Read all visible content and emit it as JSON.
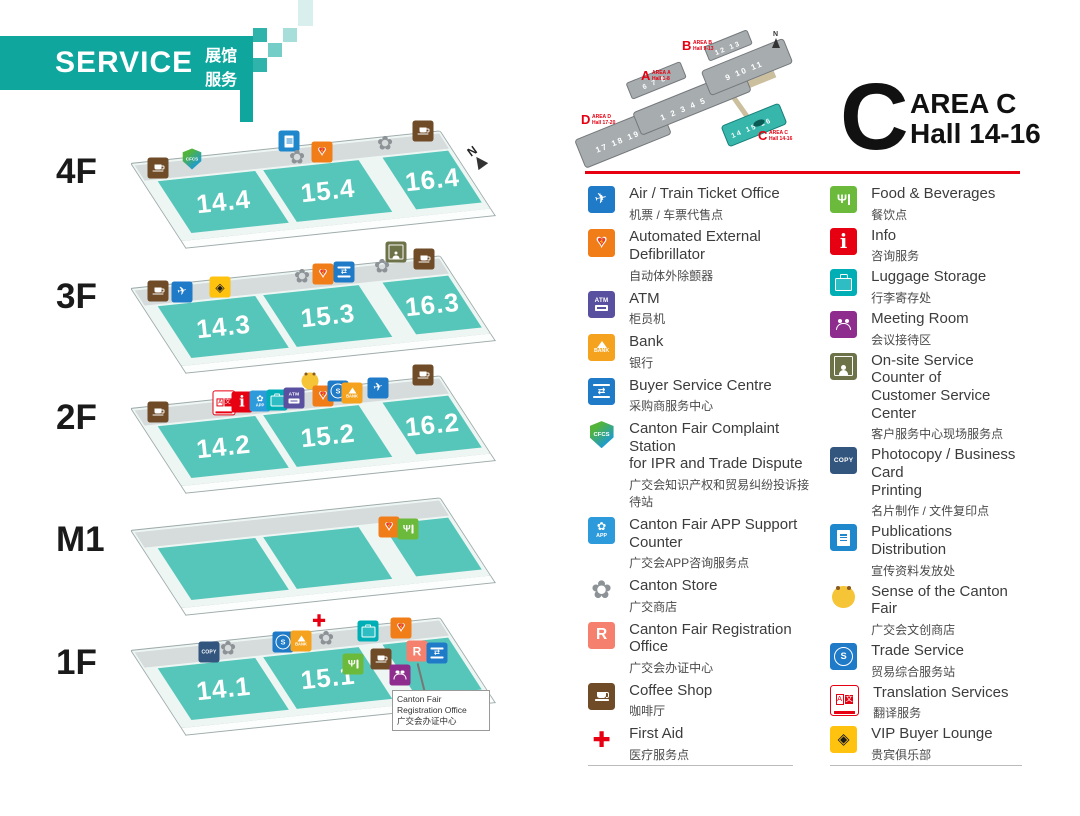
{
  "banner": {
    "title": "SERVICE",
    "subtitle_zh": "展馆服务"
  },
  "area_title": {
    "letter": "C",
    "area": "AREA C",
    "hall": "Hall 14-16"
  },
  "compass": {
    "label": "N"
  },
  "minimap": {
    "north": "N",
    "bars": {
      "a_main": "1 2 3 4 5",
      "a_up": "6 7 8",
      "b_main": "9 10 11",
      "b_up": "12 13",
      "c": "14 15 16",
      "d": "17 18 19 20"
    },
    "labels": {
      "a": {
        "letter": "A",
        "area": "AREA A",
        "hall": "Hall 1-8"
      },
      "b": {
        "letter": "B",
        "area": "AREA B",
        "hall": "Hall 9-13"
      },
      "c": {
        "letter": "C",
        "area": "AREA C",
        "hall": "Hall 14-16"
      },
      "d": {
        "letter": "D",
        "area": "AREA D",
        "hall": "Hall 17-20"
      }
    }
  },
  "floors": [
    {
      "label": "4F",
      "y": 163,
      "label_y": 152,
      "halls": [
        "14.4",
        "15.4",
        "16.4"
      ],
      "icons": [
        [
          "coffee",
          158,
          168
        ],
        [
          "cfcs",
          192,
          159
        ],
        [
          "pub",
          289,
          141
        ],
        [
          "store",
          297,
          158
        ],
        [
          "aed",
          322,
          152
        ],
        [
          "store",
          385,
          144
        ],
        [
          "coffee",
          423,
          131
        ]
      ]
    },
    {
      "label": "3F",
      "y": 288,
      "label_y": 277,
      "halls": [
        "14.3",
        "15.3",
        "16.3"
      ],
      "icons": [
        [
          "coffee",
          158,
          291
        ],
        [
          "air",
          182,
          292
        ],
        [
          "vip",
          220,
          287
        ],
        [
          "store",
          302,
          277
        ],
        [
          "aed",
          323,
          274
        ],
        [
          "buyer",
          344,
          272
        ],
        [
          "store",
          382,
          267
        ],
        [
          "onsite",
          396,
          252
        ],
        [
          "coffee",
          424,
          259
        ]
      ]
    },
    {
      "label": "2F",
      "y": 408,
      "label_y": 398,
      "halls": [
        "14.2",
        "15.2",
        "16.2"
      ],
      "icons": [
        [
          "coffee",
          158,
          412
        ],
        [
          "translate",
          224,
          403
        ],
        [
          "info",
          242,
          402
        ],
        [
          "app",
          260,
          401
        ],
        [
          "luggage",
          277,
          400
        ],
        [
          "atm",
          294,
          398
        ],
        [
          "sense",
          310,
          381
        ],
        [
          "aed",
          323,
          396
        ],
        [
          "trade",
          338,
          391
        ],
        [
          "bank",
          352,
          393
        ],
        [
          "air",
          378,
          388
        ],
        [
          "coffee",
          423,
          375
        ]
      ]
    },
    {
      "label": "M1",
      "y": 530,
      "label_y": 520,
      "halls": [
        "",
        "",
        ""
      ],
      "icons": [
        [
          "aed",
          389,
          527
        ],
        [
          "food",
          408,
          529
        ]
      ]
    },
    {
      "label": "1F",
      "y": 650,
      "label_y": 643,
      "halls": [
        "14.1",
        "15.1",
        ""
      ],
      "icons": [
        [
          "copy",
          209,
          652
        ],
        [
          "store",
          228,
          649
        ],
        [
          "trade",
          283,
          642
        ],
        [
          "bank",
          301,
          641
        ],
        [
          "firstaid",
          319,
          622
        ],
        [
          "store",
          326,
          639
        ],
        [
          "food",
          353,
          664
        ],
        [
          "luggage",
          368,
          631
        ],
        [
          "coffee",
          381,
          659
        ],
        [
          "aed",
          401,
          628
        ],
        [
          "reg",
          417,
          651
        ],
        [
          "buyer",
          437,
          653
        ],
        [
          "meeting",
          400,
          675
        ]
      ]
    }
  ],
  "callout": {
    "lines": [
      "Canton Fair",
      "Registration Office",
      "广交会办证中心"
    ]
  },
  "legend": {
    "columns": [
      [
        {
          "type": "air",
          "title": "Air / Train Ticket Office",
          "zh": "机票 / 车票代售点"
        },
        {
          "type": "aed",
          "title": "Automated External Defibrillator",
          "zh": "自动体外除颤器"
        },
        {
          "type": "atm",
          "title": "ATM",
          "zh": "柜员机"
        },
        {
          "type": "bank",
          "title": "Bank",
          "zh": "银行"
        },
        {
          "type": "buyer",
          "title": "Buyer Service Centre",
          "zh": "采购商服务中心"
        },
        {
          "type": "cfcs",
          "title": "Canton Fair Complaint Station\nfor IPR and Trade Dispute",
          "zh": "广交会知识产权和贸易纠纷投诉接待站"
        },
        {
          "type": "app",
          "title": "Canton Fair APP Support Counter",
          "zh": "广交会APP咨询服务点"
        },
        {
          "type": "store",
          "title": "Canton Store",
          "zh": "广交商店"
        },
        {
          "type": "reg",
          "title": "Canton Fair Registration Office",
          "zh": "广交会办证中心"
        },
        {
          "type": "coffee",
          "title": "Coffee Shop",
          "zh": "咖啡厅"
        },
        {
          "type": "firstaid",
          "title": "First Aid",
          "zh": "医疗服务点"
        }
      ],
      [
        {
          "type": "food",
          "title": "Food & Beverages",
          "zh": "餐饮点"
        },
        {
          "type": "info",
          "title": "Info",
          "zh": "咨询服务"
        },
        {
          "type": "luggage",
          "title": "Luggage Storage",
          "zh": "行李寄存处"
        },
        {
          "type": "meeting",
          "title": "Meeting Room",
          "zh": "会议接待区"
        },
        {
          "type": "onsite",
          "title": "On-site Service Counter of\nCustomer Service Center",
          "zh": "客户服务中心现场服务点"
        },
        {
          "type": "copy",
          "title": "Photocopy / Business Card\nPrinting",
          "zh": "名片制作 / 文件复印点"
        },
        {
          "type": "pub",
          "title": "Publications Distribution",
          "zh": "宣传资料发放处"
        },
        {
          "type": "sense",
          "title": "Sense of the Canton Fair",
          "zh": "广交会文创商店"
        },
        {
          "type": "trade",
          "title": "Trade Service",
          "zh": "贸易综合服务站"
        },
        {
          "type": "translate",
          "title": "Translation Services",
          "zh": "翻译服务"
        },
        {
          "type": "vip",
          "title": "VIP Buyer Lounge",
          "zh": "贵宾俱乐部"
        }
      ]
    ]
  },
  "colors": {
    "brand_teal": "#0FA79D",
    "hall_teal": "#57C6BA",
    "accent_red": "#E60012"
  }
}
